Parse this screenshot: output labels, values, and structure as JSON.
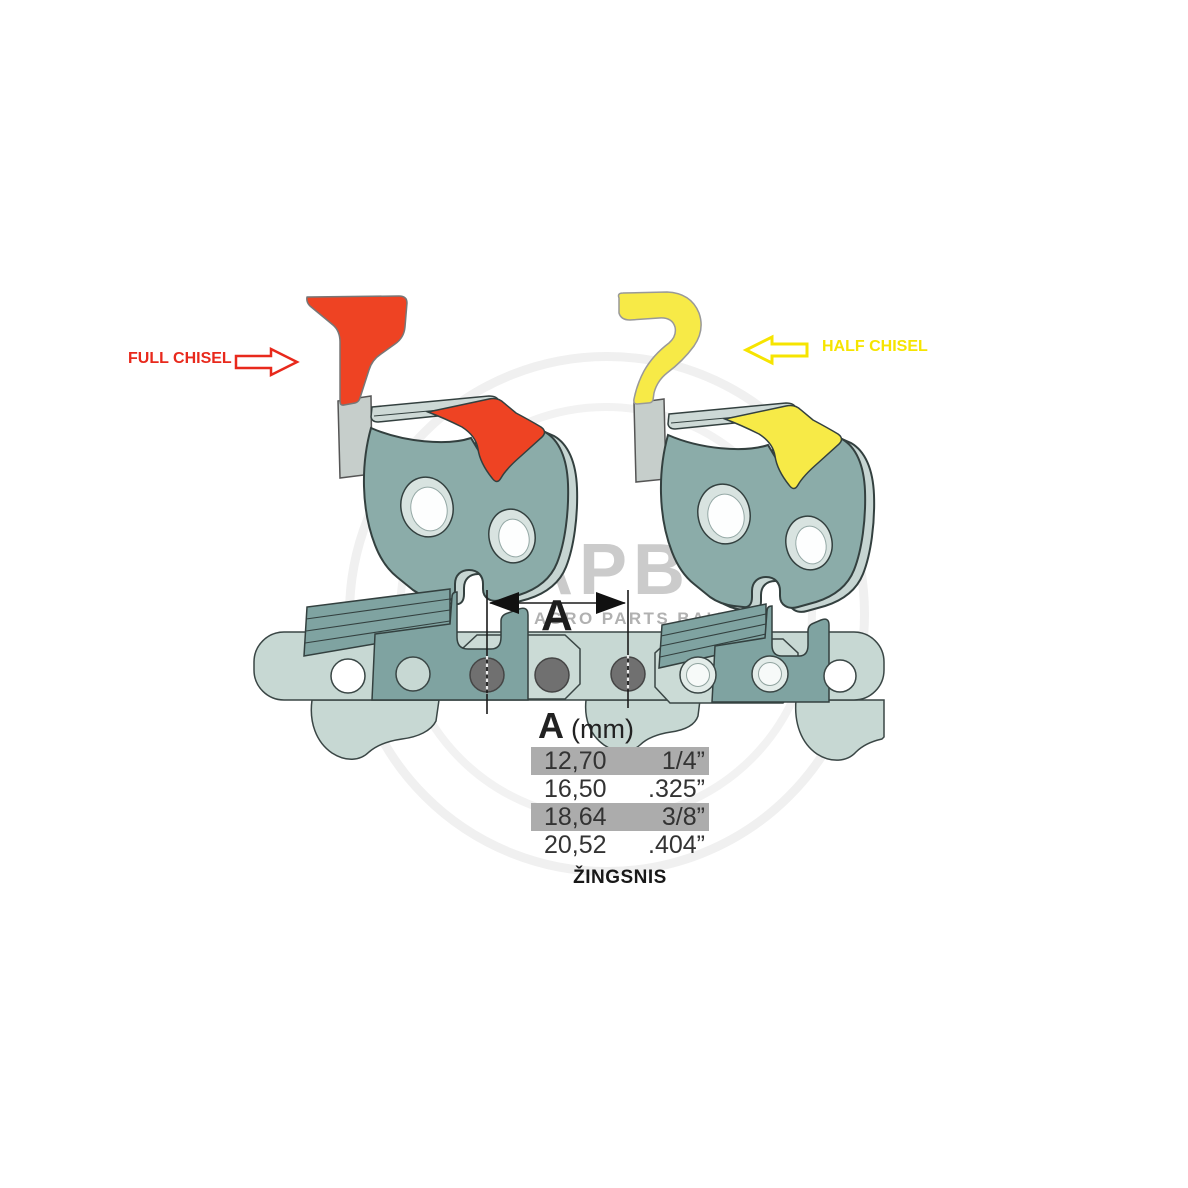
{
  "labels": {
    "full_chisel": "FULL CHISEL",
    "half_chisel": "HALF CHISEL"
  },
  "dimension": {
    "label": "A"
  },
  "pitch_table": {
    "header": {
      "letter": "A",
      "unit": "(mm)"
    },
    "rows": [
      {
        "mm": "12,70",
        "inch": "1/4”",
        "highlighted": true
      },
      {
        "mm": "16,50",
        "inch": ".325”",
        "highlighted": false
      },
      {
        "mm": "18,64",
        "inch": "3/8”",
        "highlighted": true
      },
      {
        "mm": "20,52",
        "inch": ".404”",
        "highlighted": false
      }
    ],
    "caption": "ŽINGSNIS"
  },
  "watermark": {
    "logo": "APB",
    "subtitle": "AGRO PARTS BALTIJA"
  },
  "colors": {
    "full_chisel_accent": "#ee4323",
    "half_chisel_accent": "#f7ea47",
    "cutter_body_teal": "#8bacа9",
    "chain_light_teal": "#c7d8d3",
    "chain_cutter_dark_teal": "#7fa3a1",
    "rivet_gray": "#707070",
    "table_row_highlight": "#acacac",
    "outline": "#3a4645",
    "watermark_gray": "#cbcbcb"
  },
  "chart_data": {
    "type": "table",
    "title": "Chain pitch dimension A",
    "columns": [
      "A (mm)",
      "inches"
    ],
    "rows": [
      [
        "12,70",
        "1/4”"
      ],
      [
        "16,50",
        ".325”"
      ],
      [
        "18,64",
        "3/8”"
      ],
      [
        "20,52",
        ".404”"
      ]
    ],
    "caption": "ŽINGSNIS",
    "highlighted_rows": [
      0,
      2
    ]
  }
}
